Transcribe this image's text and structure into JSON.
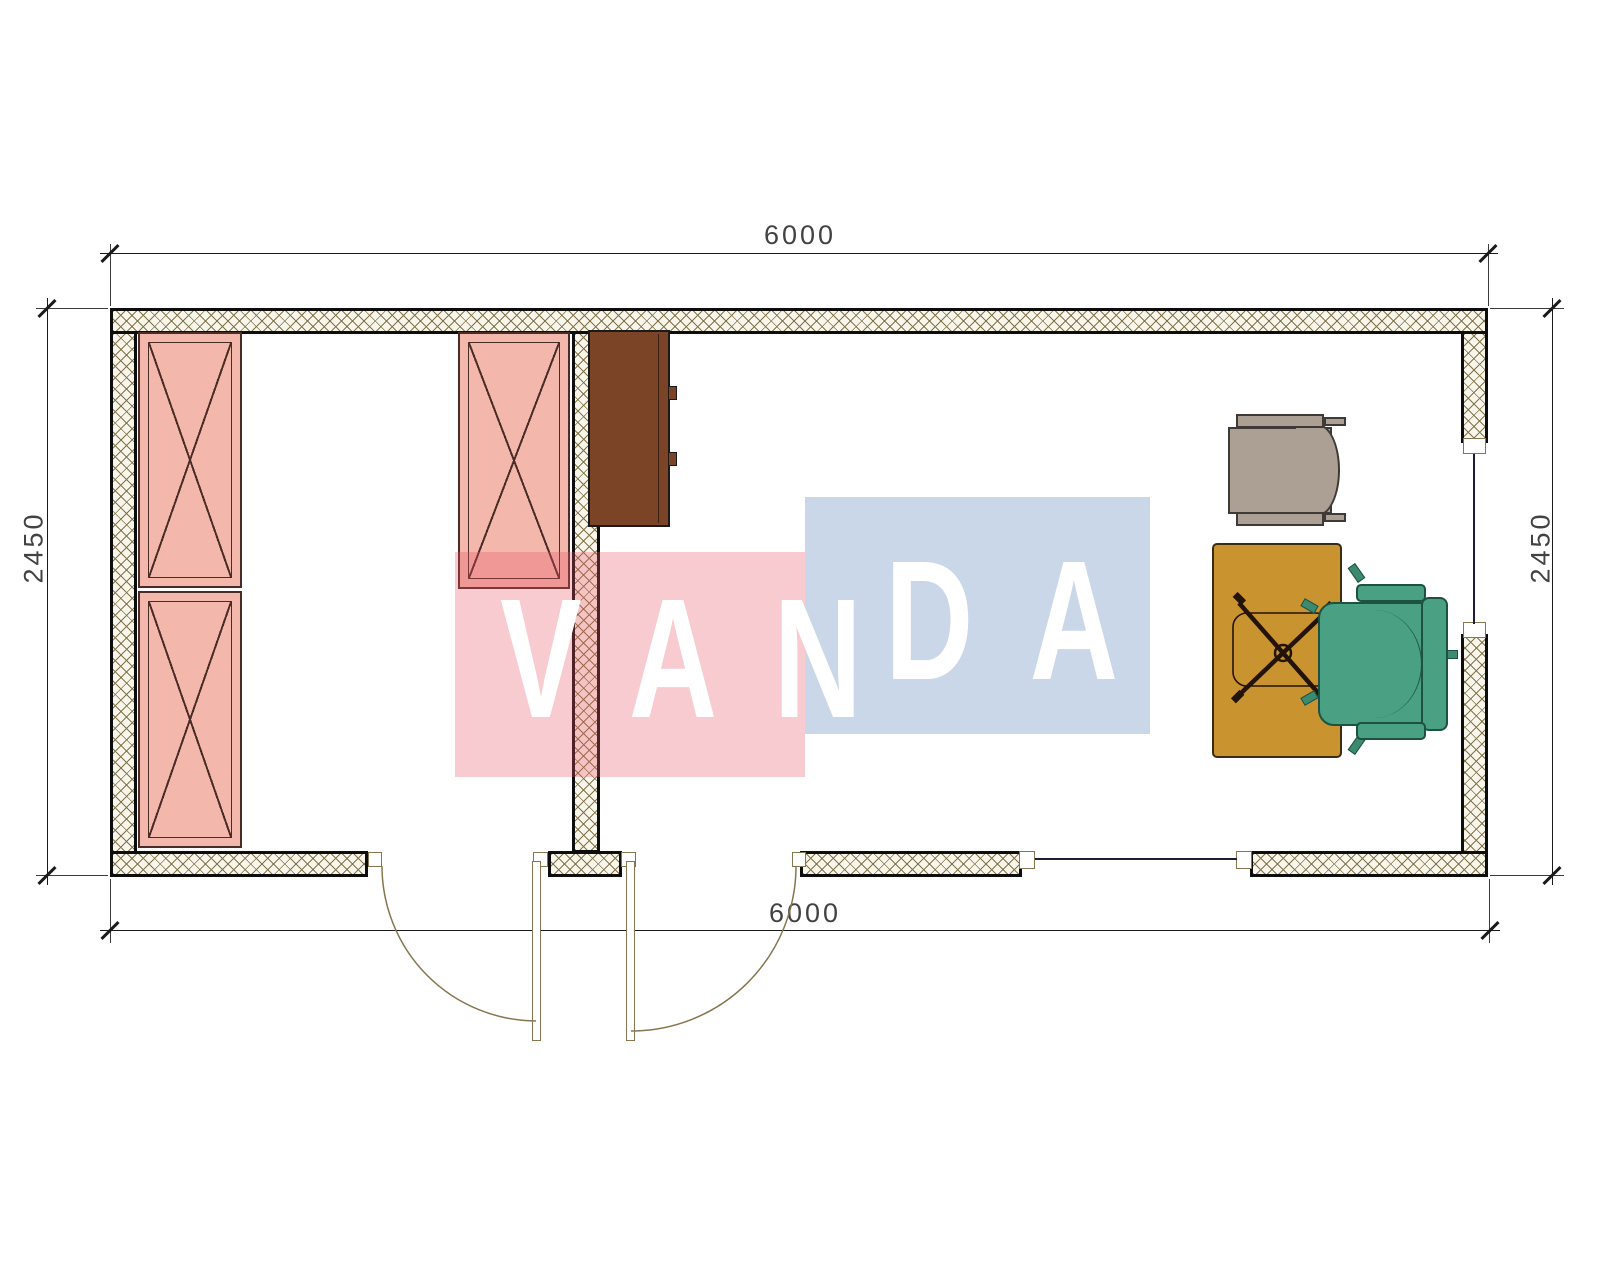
{
  "drawing": {
    "type": "architectural-floor-plan",
    "dimensions": {
      "top": "6000",
      "bottom": "6000",
      "left": "2450",
      "right": "2450",
      "units": "mm"
    },
    "watermark": {
      "text": "VANDA",
      "part1": "VAN",
      "part2": "DA"
    },
    "rooms": [
      {
        "name": "storage-room",
        "furniture": [
          "wardrobe-cabinet",
          "wardrobe-cabinet",
          "wardrobe-cabinet"
        ]
      },
      {
        "name": "office-room",
        "furniture": [
          "sideboard",
          "armchair",
          "desk",
          "office-chair"
        ]
      }
    ],
    "openings": [
      "door-left-room",
      "door-right-room",
      "window-bottom-wall",
      "window-right-wall"
    ]
  },
  "colors": {
    "wall_hatch_bg": "#f8f5ea",
    "wall_hatch_line": "#82734b",
    "wall_border": "#0d0d0d",
    "cabinet_pink": "#f3b7ac",
    "cabinet_line": "#4a2c26",
    "cabinet_brown": "#7b4426",
    "desk": "#c9932f",
    "desk_line": "#3a2c10",
    "chair_gray": "#aca095",
    "chair_gray_line": "#3f3a35",
    "chair_green": "#4aa083",
    "chair_green_line": "#1d5243",
    "door_line": "#857550",
    "glass_line": "#1c1c3a",
    "dim_line": "#1a1a1a",
    "dim_text": "#2e2e2e",
    "watermark_red": "rgba(231,84,99,0.30)",
    "watermark_blue": "rgba(116,149,197,0.38)",
    "watermark_text": "#ffffff"
  }
}
